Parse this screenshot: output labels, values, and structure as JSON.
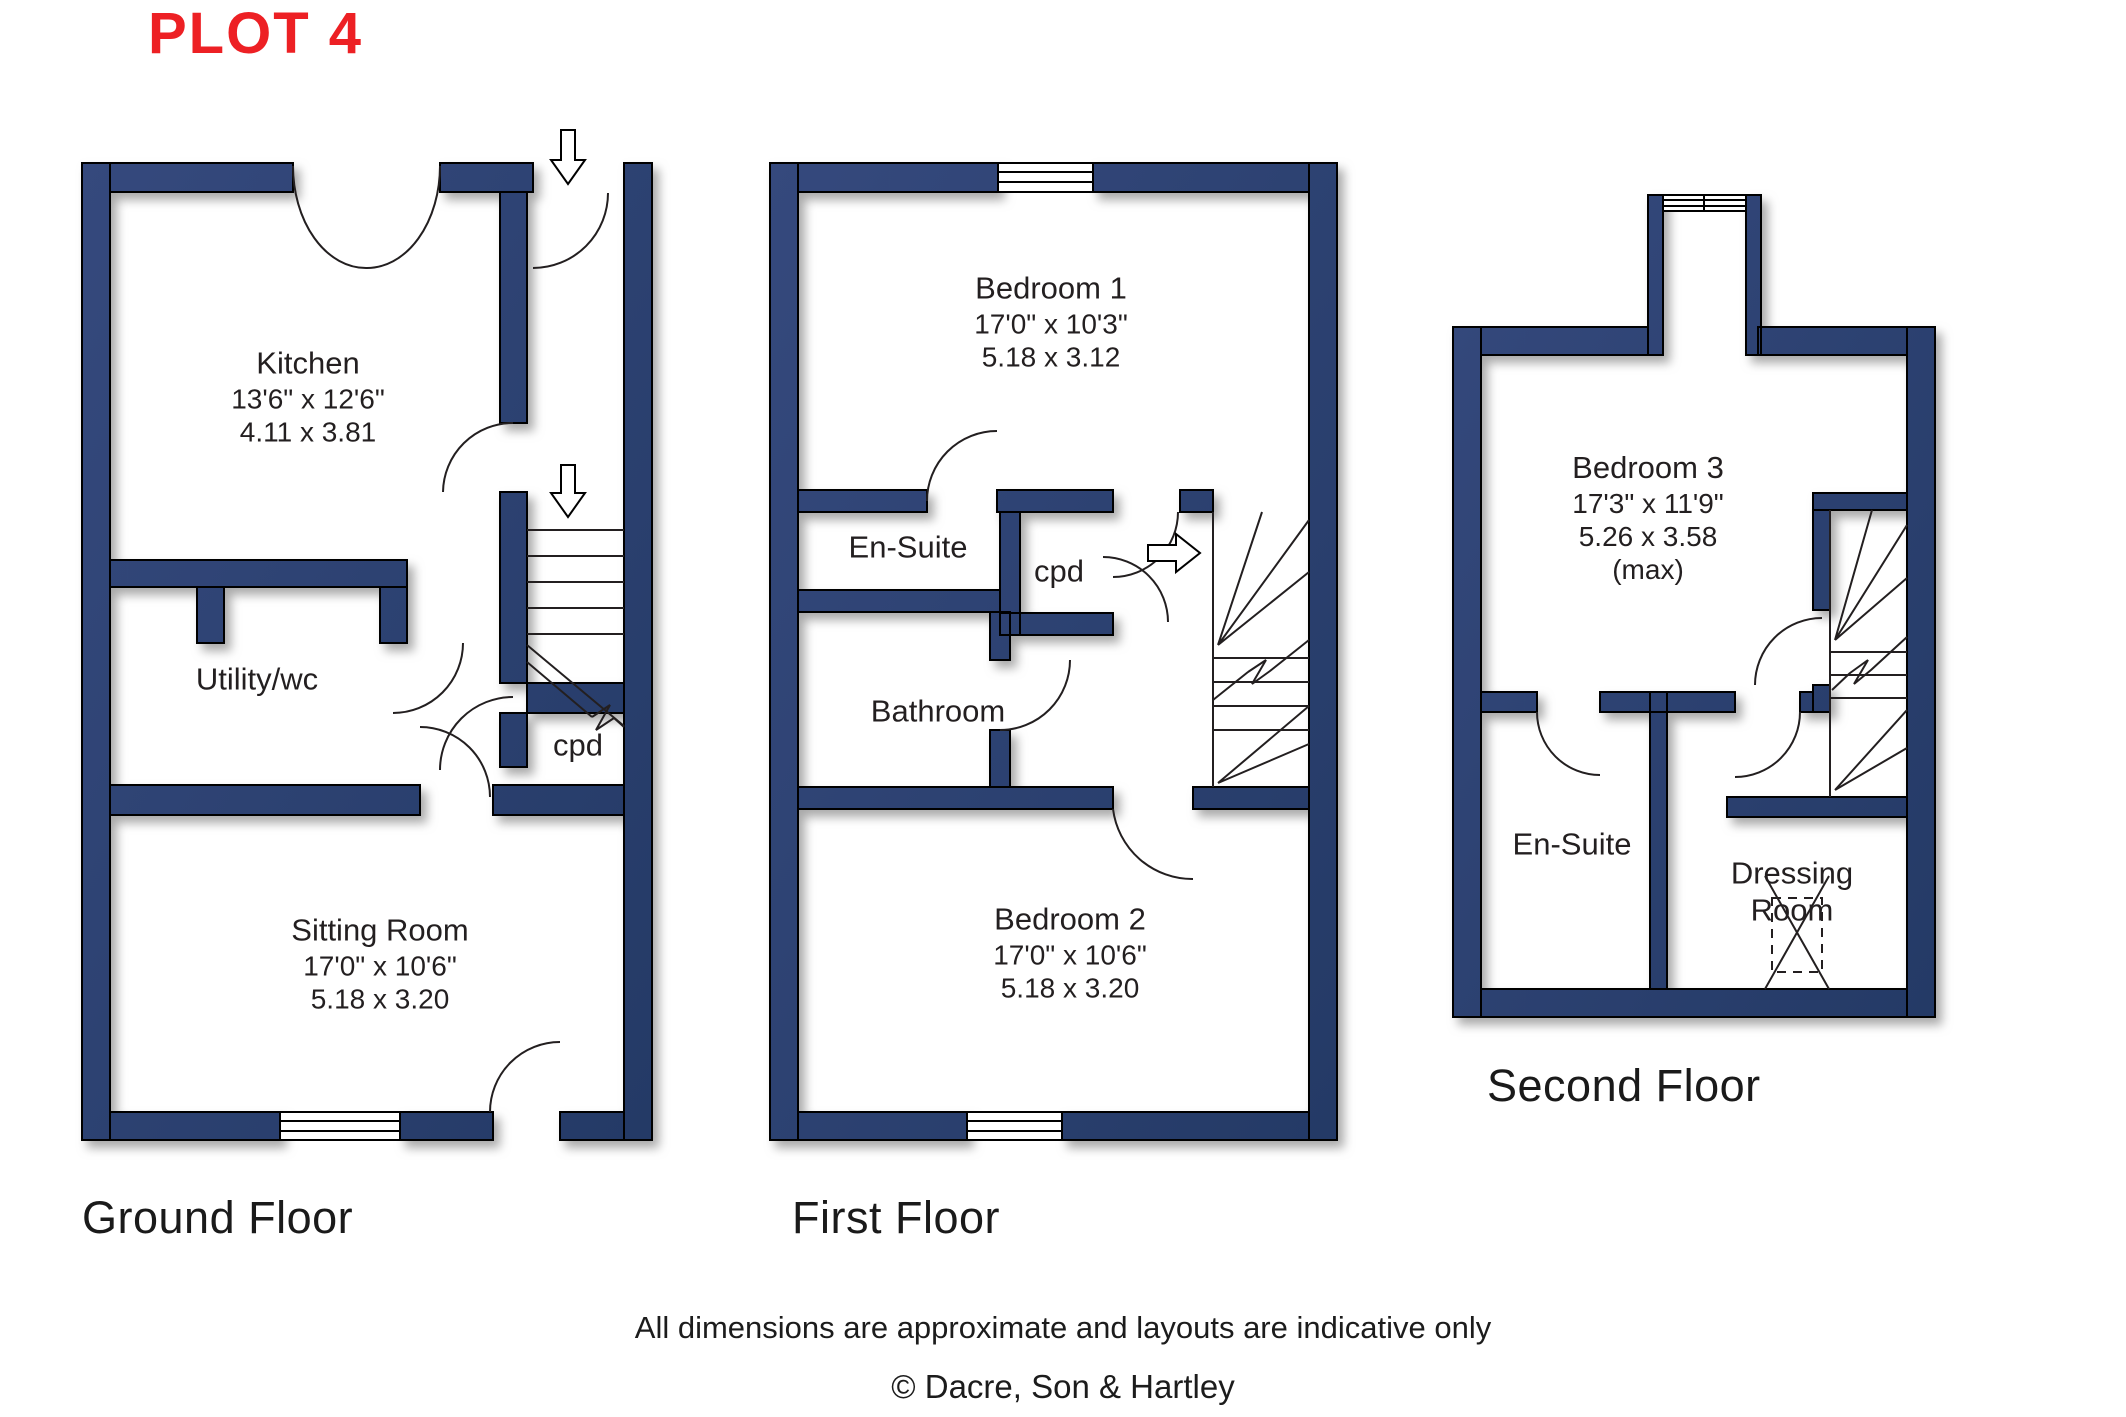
{
  "title": "PLOT 4",
  "colors": {
    "wall": "#2b4170",
    "accent_red": "#ed2024",
    "text": "#231f20"
  },
  "floors": [
    {
      "caption": "Ground Floor",
      "rooms": [
        {
          "name": "Kitchen",
          "imperial": "13'6\" x 12'6\"",
          "metric": "4.11 x 3.81"
        },
        {
          "name": "Utility/wc"
        },
        {
          "name": "cpd"
        },
        {
          "name": "Sitting Room",
          "imperial": "17'0\" x 10'6\"",
          "metric": "5.18 x 3.20"
        }
      ]
    },
    {
      "caption": "First Floor",
      "rooms": [
        {
          "name": "Bedroom 1",
          "imperial": "17'0\" x 10'3\"",
          "metric": "5.18 x 3.12"
        },
        {
          "name": "En-Suite"
        },
        {
          "name": "cpd"
        },
        {
          "name": "Bathroom"
        },
        {
          "name": "Bedroom 2",
          "imperial": "17'0\" x 10'6\"",
          "metric": "5.18 x 3.20"
        }
      ]
    },
    {
      "caption": "Second Floor",
      "rooms": [
        {
          "name": "Bedroom 3",
          "imperial": "17'3\" x 11'9\"",
          "metric": "5.26 x 3.58",
          "note": "(max)"
        },
        {
          "name": "En-Suite"
        },
        {
          "name": "Dressing Room"
        }
      ]
    }
  ],
  "footer": {
    "line1": "All dimensions are approximate and layouts are indicative only",
    "line2": "© Dacre, Son & Hartley"
  }
}
